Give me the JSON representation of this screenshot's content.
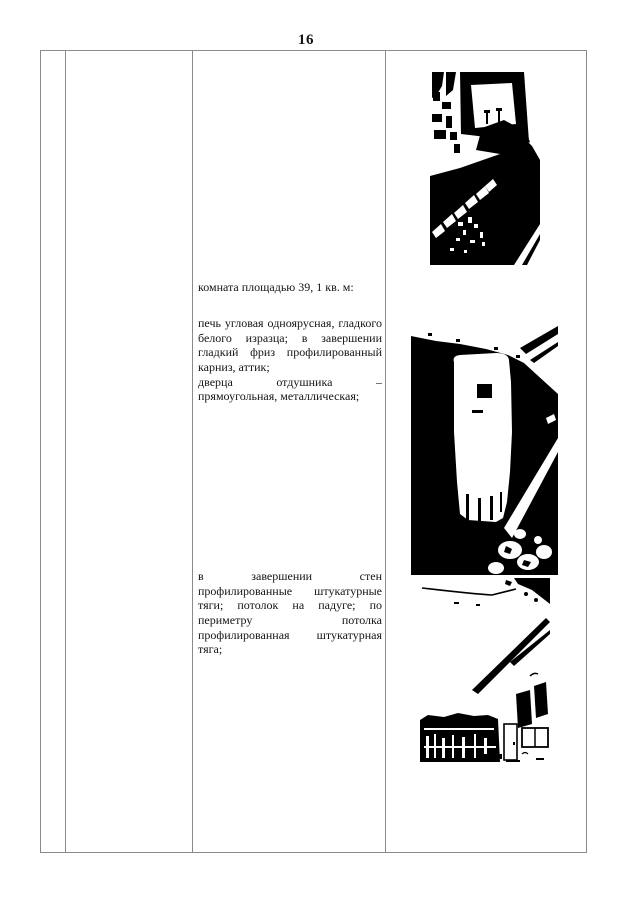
{
  "page": {
    "number": "16"
  },
  "colors": {
    "page_background": "#ffffff",
    "table_border": "#8a8a8a",
    "text_ink": "#141414",
    "photo_ink": "#000000"
  },
  "description_column": {
    "room_heading": "комната площадью 39, 1 кв. м:",
    "stove_paragraph": {
      "lines": [
        "печь угловая одноярусная, гладкого",
        "белого изразца; в завершении",
        "гладкий фриз профилированный",
        "карниз, аттик;",
        "дверца отдушника –",
        "прямоугольная, металлическая;"
      ]
    },
    "ceiling_paragraph": {
      "lines": [
        "в завершении стен",
        "профилированные штукатурные",
        "тяги; потолок на падуге; по",
        "периметру потолка",
        "профилированная штукатурная",
        "тяга;"
      ]
    }
  },
  "photo_column": {
    "photos": [
      {
        "name": "photo-window-sill-and-tiles"
      },
      {
        "name": "photo-corner-tiled-stove"
      },
      {
        "name": "photo-room-ceiling-cornice"
      }
    ]
  }
}
